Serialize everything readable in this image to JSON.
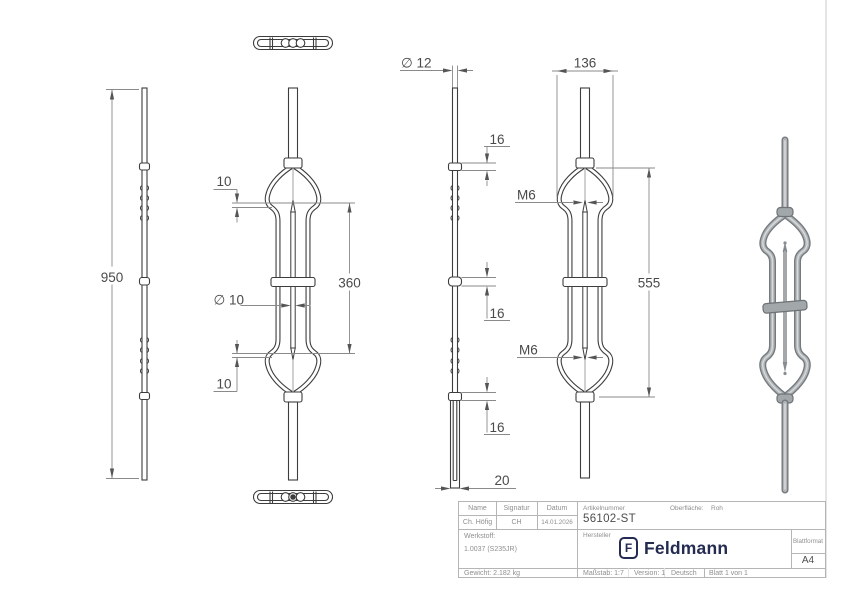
{
  "drawing": {
    "side_profile": {
      "height": "950"
    },
    "front": {
      "tip_offset_top": "10",
      "rod_dia": "∅ 10",
      "span": "360",
      "tip_offset_bottom": "10"
    },
    "side": {
      "bar_dia": "∅ 12",
      "collar_top": "16",
      "collar_mid": "16",
      "collar_bottom": "16",
      "base_width": "20"
    },
    "front_rotated": {
      "width": "136",
      "thread_top": "M6",
      "span": "555",
      "thread_bottom": "M6"
    }
  },
  "title_block": {
    "name_label": "Name",
    "signatur_label": "Signatur",
    "datum_label": "Datum",
    "name_value": "Ch. Höfig",
    "signatur_value": "CH",
    "datum_value": "14.01.2026",
    "artikelnummer_label": "Artikelnummer",
    "artikelnummer_value": "56102-ST",
    "oberflaeche_label": "Oberfläche:",
    "oberflaeche_value": "Roh",
    "werkstoff_label": "Werkstoff:",
    "werkstoff_value": "1.0037 (S235JR)",
    "hersteller_label": "Hersteller",
    "logo_mark": "F",
    "logo_text": "Feldmann",
    "blattformat_label": "Blattformat",
    "blattformat_value": "A4",
    "gewicht": "Gewicht: 2.182 kg",
    "massstab": "Maßstab: 1:7",
    "version": "Version: 1",
    "sprache": "Deutsch",
    "blatt": "Blatt 1 von 1"
  },
  "colors": {
    "line": "#3d3d3d",
    "dim_line": "#8a8a8a",
    "dim_text": "#4a4a4a",
    "logo": "#242c52",
    "render": "#b0b4b7"
  }
}
